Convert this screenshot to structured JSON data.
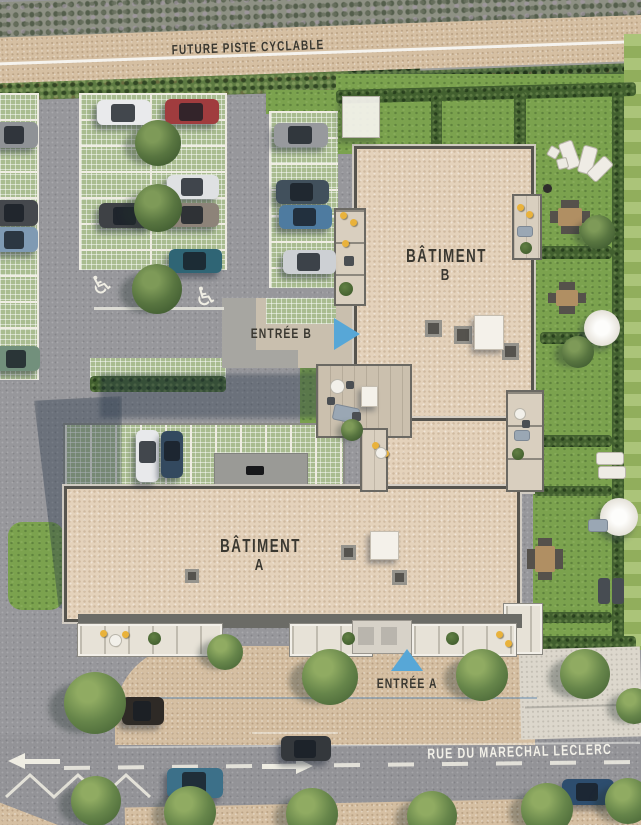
{
  "labels": {
    "bike_path": "FUTURE PISTE CYCLABLE",
    "building_b": "BÂTIMENT",
    "building_b_letter": "B",
    "building_a": "BÂTIMENT",
    "building_a_letter": "A",
    "entrance_b": "ENTRÉE B",
    "entrance_a": "ENTRÉE A",
    "street": "RUE DU MARECHAL LECLERC",
    "accessible_icon": "♿"
  },
  "colors": {
    "accent_blue": "#57a7d7",
    "roof_beige": "#e4d2bb",
    "lawn_green": "#7ba24e",
    "asphalt_gray": "#97979b",
    "path_tan": "#d5bfa2",
    "hedge_green": "#42602f",
    "label_dark": "#3a3831",
    "marking_white": "#efede3"
  },
  "scene": {
    "cars": [
      {
        "x": -8,
        "y": 122,
        "w": 46,
        "h": 26,
        "c": "#8f9296"
      },
      {
        "x": -8,
        "y": 200,
        "w": 46,
        "h": 26,
        "c": "#45484d"
      },
      {
        "x": -8,
        "y": 227,
        "w": 46,
        "h": 25,
        "c": "#7f9ab3"
      },
      {
        "x": -6,
        "y": 346,
        "w": 46,
        "h": 25,
        "c": "#72907c"
      },
      {
        "x": 97,
        "y": 100,
        "w": 54,
        "h": 25,
        "c": "#e9eaec"
      },
      {
        "x": 99,
        "y": 203,
        "w": 53,
        "h": 25,
        "c": "#3e4145"
      },
      {
        "x": 165,
        "y": 99,
        "w": 54,
        "h": 25,
        "c": "#a03c3e"
      },
      {
        "x": 167,
        "y": 175,
        "w": 52,
        "h": 24,
        "c": "#dfe1e3"
      },
      {
        "x": 167,
        "y": 203,
        "w": 52,
        "h": 24,
        "c": "#8d8379"
      },
      {
        "x": 169,
        "y": 249,
        "w": 53,
        "h": 24,
        "c": "#2f6575"
      },
      {
        "x": 274,
        "y": 123,
        "w": 54,
        "h": 24,
        "c": "#97999d"
      },
      {
        "x": 276,
        "y": 180,
        "w": 53,
        "h": 24,
        "c": "#41505c"
      },
      {
        "x": 279,
        "y": 205,
        "w": 53,
        "h": 24,
        "c": "#4e7ba0"
      },
      {
        "x": 283,
        "y": 250,
        "w": 53,
        "h": 24,
        "c": "#cdd0d4"
      },
      {
        "x": 136,
        "y": 430,
        "w": 23,
        "h": 52,
        "c": "#e8e9eb",
        "v": true
      },
      {
        "x": 161,
        "y": 431,
        "w": 22,
        "h": 47,
        "c": "#33495f",
        "v": true
      },
      {
        "x": 122,
        "y": 697,
        "w": 42,
        "h": 28,
        "c": "#2e2a26"
      },
      {
        "x": 281,
        "y": 736,
        "w": 50,
        "h": 25,
        "c": "#34383c"
      },
      {
        "x": 167,
        "y": 768,
        "w": 56,
        "h": 30,
        "c": "#3c7089"
      },
      {
        "x": 562,
        "y": 779,
        "w": 52,
        "h": 26,
        "c": "#2d4d6e"
      }
    ],
    "trees": [
      {
        "x": 158,
        "y": 143,
        "d": 46,
        "t": "dark"
      },
      {
        "x": 158,
        "y": 208,
        "d": 48,
        "t": "dark"
      },
      {
        "x": 157,
        "y": 289,
        "d": 50,
        "t": "dark"
      },
      {
        "x": 578,
        "y": 352,
        "d": 32,
        "t": "dark"
      },
      {
        "x": 598,
        "y": 232,
        "d": 34,
        "t": "dark"
      },
      {
        "x": 352,
        "y": 430,
        "d": 22,
        "t": "dark"
      },
      {
        "x": 95,
        "y": 703,
        "d": 62,
        "t": "mid"
      },
      {
        "x": 225,
        "y": 652,
        "d": 36,
        "t": "mid"
      },
      {
        "x": 330,
        "y": 677,
        "d": 56,
        "t": "mid"
      },
      {
        "x": 482,
        "y": 675,
        "d": 52,
        "t": "mid"
      },
      {
        "x": 585,
        "y": 674,
        "d": 50,
        "t": "mid"
      },
      {
        "x": 634,
        "y": 706,
        "d": 36,
        "t": "mid"
      },
      {
        "x": 96,
        "y": 801,
        "d": 50,
        "t": "mid"
      },
      {
        "x": 190,
        "y": 812,
        "d": 52,
        "t": "mid"
      },
      {
        "x": 312,
        "y": 814,
        "d": 52,
        "t": "mid"
      },
      {
        "x": 432,
        "y": 816,
        "d": 50,
        "t": "mid"
      },
      {
        "x": 547,
        "y": 809,
        "d": 52,
        "t": "mid"
      },
      {
        "x": 628,
        "y": 801,
        "d": 46,
        "t": "mid"
      }
    ],
    "items": [
      {
        "type": "canopy",
        "x": 342,
        "y": 96,
        "w": 36,
        "h": 40
      },
      {
        "type": "lounger-light",
        "x": 562,
        "y": 141,
        "w": 13,
        "h": 26,
        "rot": -20
      },
      {
        "type": "lounger-light",
        "x": 580,
        "y": 146,
        "w": 13,
        "h": 26,
        "rot": 15
      },
      {
        "type": "lounger-light",
        "x": 593,
        "y": 156,
        "w": 12,
        "h": 24,
        "rot": 45
      },
      {
        "type": "chair-white",
        "x": 548,
        "y": 147,
        "w": 9,
        "h": 9,
        "rot": 30
      },
      {
        "type": "chair-white",
        "x": 557,
        "y": 158,
        "w": 9,
        "h": 9,
        "rot": -15
      },
      {
        "type": "grill",
        "x": 543,
        "y": 184,
        "w": 9,
        "h": 9
      },
      {
        "type": "table-wood",
        "x": 558,
        "y": 208,
        "w": 24,
        "h": 18
      },
      {
        "type": "table-wood",
        "x": 556,
        "y": 290,
        "w": 22,
        "h": 16
      },
      {
        "type": "parasol",
        "x": 584,
        "y": 310,
        "w": 36,
        "h": 36
      },
      {
        "type": "parasol",
        "x": 600,
        "y": 498,
        "w": 38,
        "h": 38
      },
      {
        "type": "sofa-gray",
        "x": 588,
        "y": 519,
        "w": 18,
        "h": 11
      },
      {
        "type": "lounger-light",
        "x": 596,
        "y": 452,
        "w": 26,
        "h": 11
      },
      {
        "type": "lounger-light",
        "x": 598,
        "y": 466,
        "w": 26,
        "h": 11
      },
      {
        "type": "lounger-dark",
        "x": 598,
        "y": 578,
        "w": 12,
        "h": 26
      },
      {
        "type": "lounger-dark",
        "x": 612,
        "y": 578,
        "w": 12,
        "h": 26
      },
      {
        "type": "table-wood",
        "x": 535,
        "y": 546,
        "w": 20,
        "h": 26
      },
      {
        "type": "yellow",
        "x": 340,
        "y": 212,
        "d": 7
      },
      {
        "type": "yellow",
        "x": 350,
        "y": 219,
        "d": 7
      },
      {
        "type": "yellow",
        "x": 342,
        "y": 240,
        "d": 7
      },
      {
        "type": "chair-dark",
        "x": 344,
        "y": 256,
        "w": 10,
        "h": 10
      },
      {
        "type": "planter",
        "x": 339,
        "y": 282,
        "d": 14
      },
      {
        "type": "yellow",
        "x": 517,
        "y": 204,
        "d": 7
      },
      {
        "type": "yellow",
        "x": 526,
        "y": 211,
        "d": 7
      },
      {
        "type": "sofa-gray",
        "x": 517,
        "y": 226,
        "w": 14,
        "h": 9
      },
      {
        "type": "planter",
        "x": 520,
        "y": 242,
        "d": 12
      },
      {
        "type": "table-white",
        "x": 330,
        "y": 379,
        "d": 13
      },
      {
        "type": "chair-dark",
        "x": 346,
        "y": 381,
        "w": 8,
        "h": 8
      },
      {
        "type": "chair-dark",
        "x": 327,
        "y": 397,
        "w": 8,
        "h": 8
      },
      {
        "type": "sofa-gray",
        "x": 333,
        "y": 406,
        "w": 24,
        "h": 14,
        "rot": 12
      },
      {
        "type": "chair-dark",
        "x": 352,
        "y": 412,
        "w": 9,
        "h": 9
      },
      {
        "type": "yellow",
        "x": 372,
        "y": 442,
        "d": 7
      },
      {
        "type": "yellow",
        "x": 382,
        "y": 450,
        "d": 7
      },
      {
        "type": "table-white",
        "x": 375,
        "y": 447,
        "d": 10
      },
      {
        "type": "yellow",
        "x": 100,
        "y": 630,
        "d": 7
      },
      {
        "type": "yellow",
        "x": 112,
        "y": 639,
        "d": 7
      },
      {
        "type": "yellow",
        "x": 122,
        "y": 631,
        "d": 7
      },
      {
        "type": "table-white",
        "x": 109,
        "y": 634,
        "d": 11
      },
      {
        "type": "planter",
        "x": 148,
        "y": 632,
        "d": 13
      },
      {
        "type": "planter",
        "x": 342,
        "y": 632,
        "d": 13
      },
      {
        "type": "planter",
        "x": 446,
        "y": 632,
        "d": 13
      },
      {
        "type": "yellow",
        "x": 496,
        "y": 631,
        "d": 7
      },
      {
        "type": "yellow",
        "x": 505,
        "y": 640,
        "d": 7
      },
      {
        "type": "table-white",
        "x": 514,
        "y": 408,
        "d": 10
      },
      {
        "type": "chair-dark",
        "x": 522,
        "y": 420,
        "w": 8,
        "h": 8
      },
      {
        "type": "sofa-gray",
        "x": 514,
        "y": 430,
        "w": 14,
        "h": 9
      },
      {
        "type": "planter",
        "x": 512,
        "y": 448,
        "d": 12
      }
    ]
  }
}
